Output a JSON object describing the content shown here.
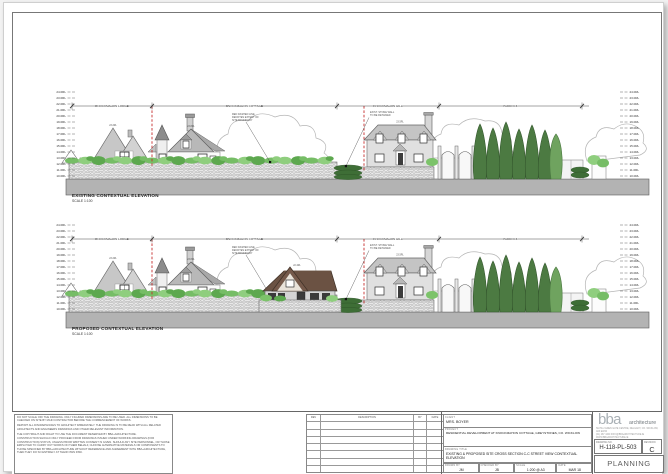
{
  "sheet": {
    "captions": {
      "existing_title": "EXISTING CONTEXTUAL ELEVATION",
      "existing_scale": "SCALE 1:100",
      "proposed_title": "PROPOSED CONTEXTUAL ELEVATION",
      "proposed_scale": "SCALE 1:100"
    },
    "property_labels": [
      "KNOCKMAHON LODGE",
      "KNOCKMAHON COTTAGE",
      "KNOCKMAHON HILL",
      "PADDOCK"
    ],
    "levels": [
      "24.0RL",
      "23.0RL",
      "22.0RL",
      "21.0RL",
      "20.0RL",
      "19.0RL",
      "18.0RL",
      "17.0RL",
      "16.0RL",
      "15.0RL",
      "14.0RL",
      "13.0RL",
      "12.0RL",
      "11.0RL",
      "10.0RL"
    ],
    "ridge_levels": {
      "lodge": "23.2RL",
      "cottage": "23.8RL",
      "hill": "23.5RL",
      "new": "22.4RL"
    },
    "annotations": {
      "boundary_note": [
        "RED DASHED LINE",
        "DENOTES EXTENT OF",
        "SITE BOUNDARY"
      ],
      "wall_note": [
        "EXIST. STONE WALL",
        "TO BE RETAINED"
      ]
    },
    "colors": {
      "boundary_red": "#c62f2f",
      "tree_dark": "#4c7a42",
      "shrub_green": "#7cc36a",
      "ground_grey": "#b3b3b3",
      "roof_brown": "#6b5243"
    }
  },
  "title_block": {
    "notes": [
      "DO NOT SCALE OFF THE DRAWING. ONLY FIGURED DIMENSIONS ARE TO BE USED. ALL DIMENSIONS TO BE CHECKED ON SITE BY MAIN CONTRACTOR BEFORE THE COMMENCEMENT OF WORKS.",
      "REPORT ALL DISCREPANCIES TO ARCHITECT IMMEDIATELY. THE DRAWING IS TO BE READ WITH ALL RELATED ARCHITECTS AND ENGINEERS DRAWINGS AND OTHER RELEVANT INFORMATION.",
      "THE COPYRIGHT AND RIGHT TO USE THE DOCUMENT RESERVED BY BBA+ARCHITECTURE.",
      "CONSTRUCTION SHOULD ONLY PROCEED FROM DRAWINGS ISSUED UNDER WORKING DRAWINGS (FOR CONSTRUCTION) STATUS, UNLESS PRIOR WRITTEN CONSENT IS GIVEN. SHOULD ANY SITE PERSONNEL, OR THOSE EMPLOYED TO CARRY OUT WORKS ON THEIR BEHALF, CHOOSE ALTERNATIVE MATERIALS OR COMPONENTS TO THOSE SPECIFIED BY BBA+ARCHITECTURE WITHOUT REFERENCE AND AGREEMENT WITH BBA+ARCHITECTURE, THEN THEY DO SO ENTIRELY AT THEIR OWN RISK."
    ],
    "revision_table": {
      "headers": [
        "REV",
        "DESCRIPTION",
        "BY",
        "DATE"
      ],
      "empty_rows": 7
    },
    "client_label": "CLIENT",
    "client": "MRS. BOYER",
    "project_label": "PROJECT",
    "project": "RESIDENTIAL DEVELOPMENT AT KNOCKMAHON COTTAGE, GREYSTONES, CO. WICKLOW",
    "drawing_title_label": "DRAWING TITLE",
    "drawing_title": "EXISTING & PROPOSED SITE CROSS SECTION C-C STREET VIEW CONTEXTUAL ELEVATION",
    "drawn_by_label": "DRAWN BY",
    "drawn_by": "JM",
    "checked_by_label": "CHECKED BY",
    "checked_by": "JB",
    "scale_label": "SCALE",
    "scale": "1:200 @ A3",
    "date_label": "DATE",
    "date": "MAR 18",
    "firm": {
      "name": "bba",
      "suffix": "architecture",
      "address_line1": "SUITE 2 EDEN GATE CENTRE, DELGANY, CO. WICKLOW, A63 EW40",
      "address_line2": "(01) 287 4400   INFO@BBAARCHITECTURE.IE   WWW.BBAARCHITECTURE.IE"
    },
    "drawing_no_label": "DRAWING NO.",
    "drawing_no": "H-118-PL-503",
    "revision_label": "REVISION",
    "revision": "C",
    "status": "PLANNING ISSUE"
  }
}
